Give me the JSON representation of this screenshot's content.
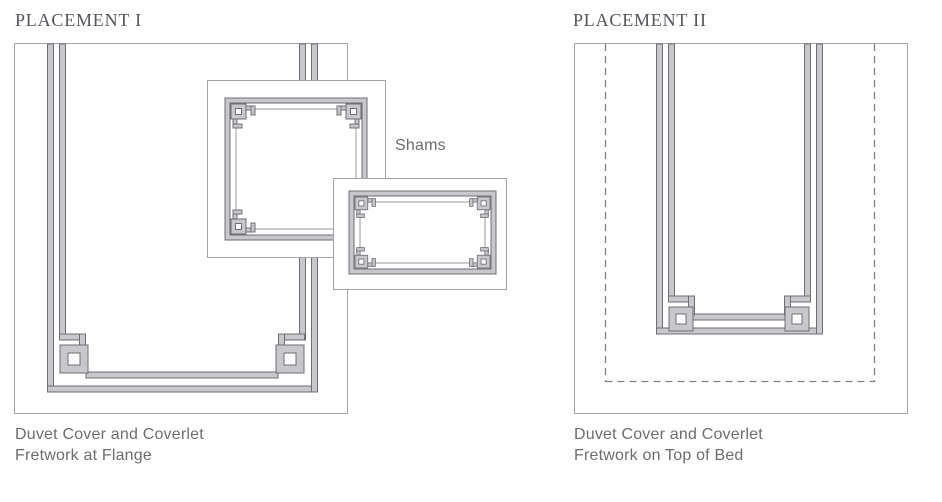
{
  "placement1": {
    "title": "PLACEMENT I",
    "sham_label": "Shams",
    "caption_line1": "Duvet Cover and Coverlet",
    "caption_line2": "Fretwork at Flange"
  },
  "placement2": {
    "title": "PLACEMENT II",
    "caption_line1": "Duvet Cover and Coverlet",
    "caption_line2": "Fretwork on Top of Bed"
  },
  "colors": {
    "band_fill": "#c8c7cb",
    "band_outline": "#6f6e73",
    "outline_thin": "#a4a3a8",
    "thin_line": "#9a999e",
    "dashed_line": "#7f7e83",
    "heading_text": "#54555a",
    "caption_text": "#6c6d70",
    "background": "#ffffff"
  }
}
